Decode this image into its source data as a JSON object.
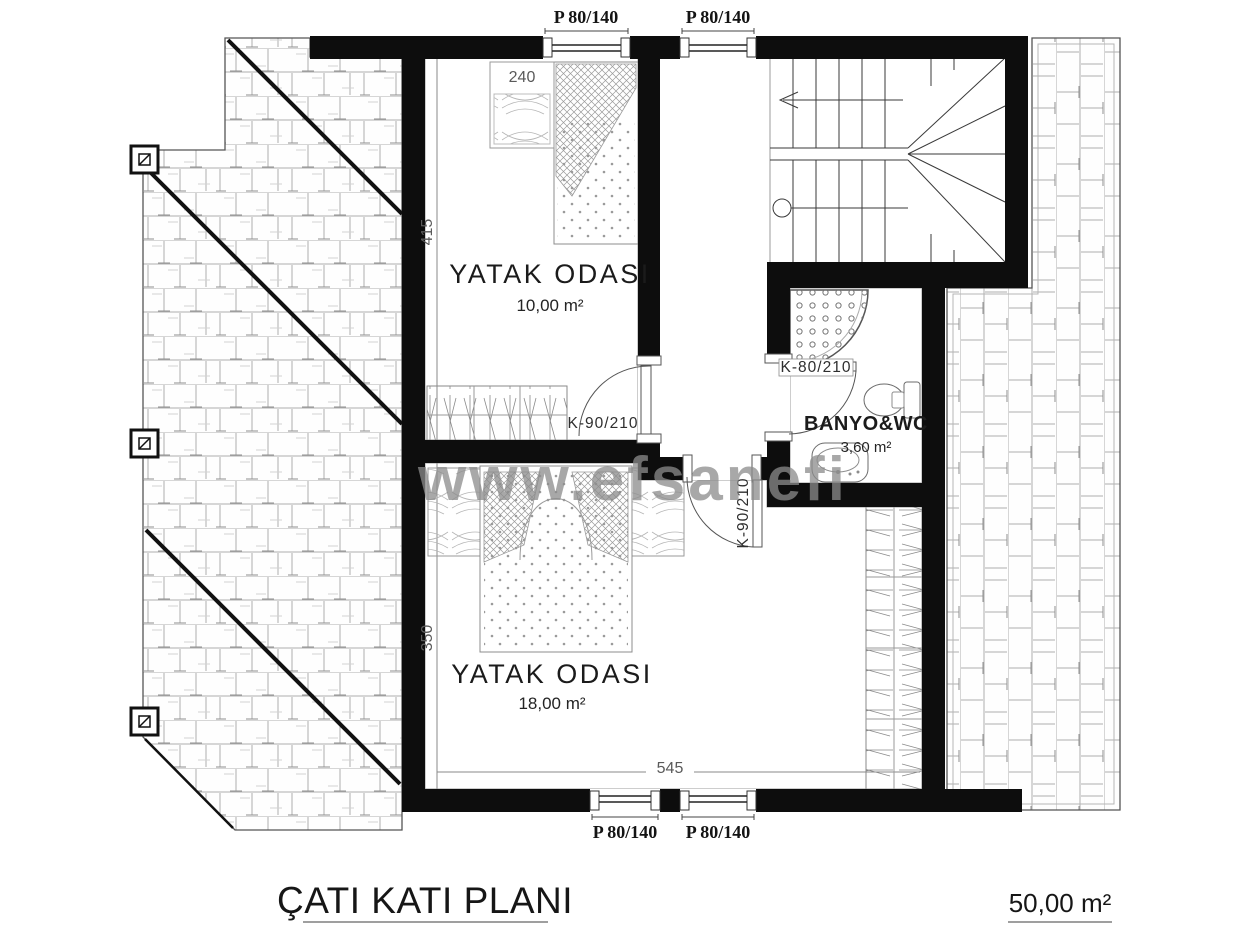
{
  "plan": {
    "title": "ÇATI KATI PLANI",
    "total_area": "50,00 m²",
    "watermark": "www.efsanefi",
    "rooms": [
      {
        "name": "YATAK ODASI",
        "area": "10,00 m²"
      },
      {
        "name": "YATAK ODASI",
        "area": "18,00 m²"
      },
      {
        "name": "BANYO&WC",
        "area": "3,60 m²"
      }
    ],
    "window_labels": [
      "P 80/140",
      "P 80/140",
      "P 80/140",
      "P 80/140"
    ],
    "door_labels": {
      "bedroom1": "K-90/210",
      "bedroom2": "K-90/210",
      "bathroom": "K-80/210"
    },
    "dimensions": {
      "bed_width": "240",
      "room1_depth": "415",
      "room2_depth": "350",
      "plan_width": "545"
    }
  },
  "colors": {
    "wall": "#0d0d0d",
    "thin_line": "#555555",
    "watermark": "#8c8c8c"
  }
}
